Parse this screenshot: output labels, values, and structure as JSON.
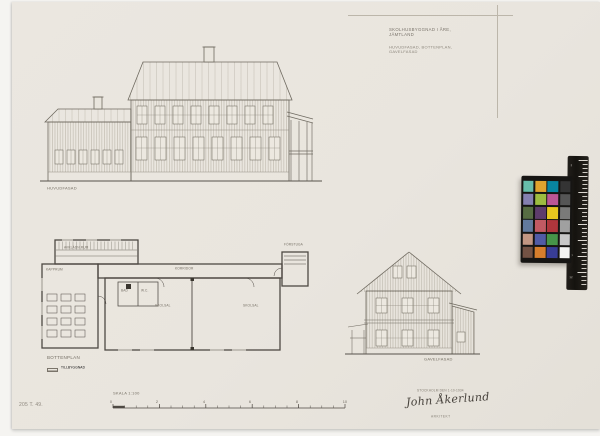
{
  "document": {
    "archive_number": "205 T. 49.",
    "title_block": {
      "line1": "SKOLHUSBYGGNAD I ÅRE, JÄMTLAND",
      "line2": "HUVUDFASAD, BOTTENPLAN, GAVELFASAD"
    },
    "labels": {
      "front_elevation": "HUVUDFASAD",
      "plan": "BOTTENPLAN",
      "legend_swatch": "TILLBYGGNAD",
      "gable_elevation": "GAVELFASAD",
      "scale": "SKALA 1:100"
    },
    "plan_rooms": {
      "cloakroom": "AVKLÄDN.RUM",
      "kapprum": "KAPPRUM",
      "corridor": "KORRIDOR",
      "bath": "BAD",
      "wc": "W.C.",
      "classroom1": "SKOLSAL",
      "classroom2": "SKOLSAL",
      "entry": "FÖRSTUGA"
    },
    "scale_bar": {
      "numbers": [
        "0",
        "2",
        "4",
        "6",
        "8",
        "10"
      ]
    },
    "signature": {
      "place_date": "STOCKHOLM DEN 1-10-1934",
      "name": "John Åkerlund",
      "role": "ARKITEKT"
    }
  },
  "color_card": {
    "patches": [
      [
        "#67bdaa",
        "#e0a32e",
        "#0885a1",
        "#343434"
      ],
      [
        "#8580b1",
        "#9dbc40",
        "#bb5695",
        "#555555"
      ],
      [
        "#576c43",
        "#5e3c6c",
        "#e7c71f",
        "#7a7a79"
      ],
      [
        "#627a9d",
        "#c15a63",
        "#af363c",
        "#a0a0a0"
      ],
      [
        "#c29682",
        "#505ba6",
        "#469449",
        "#c8c8c8"
      ],
      [
        "#735244",
        "#d67e2c",
        "#383d96",
        "#f3f3f2"
      ]
    ],
    "ruler_numbers": [
      "2",
      "4",
      "6",
      "8",
      "10",
      "12"
    ]
  }
}
